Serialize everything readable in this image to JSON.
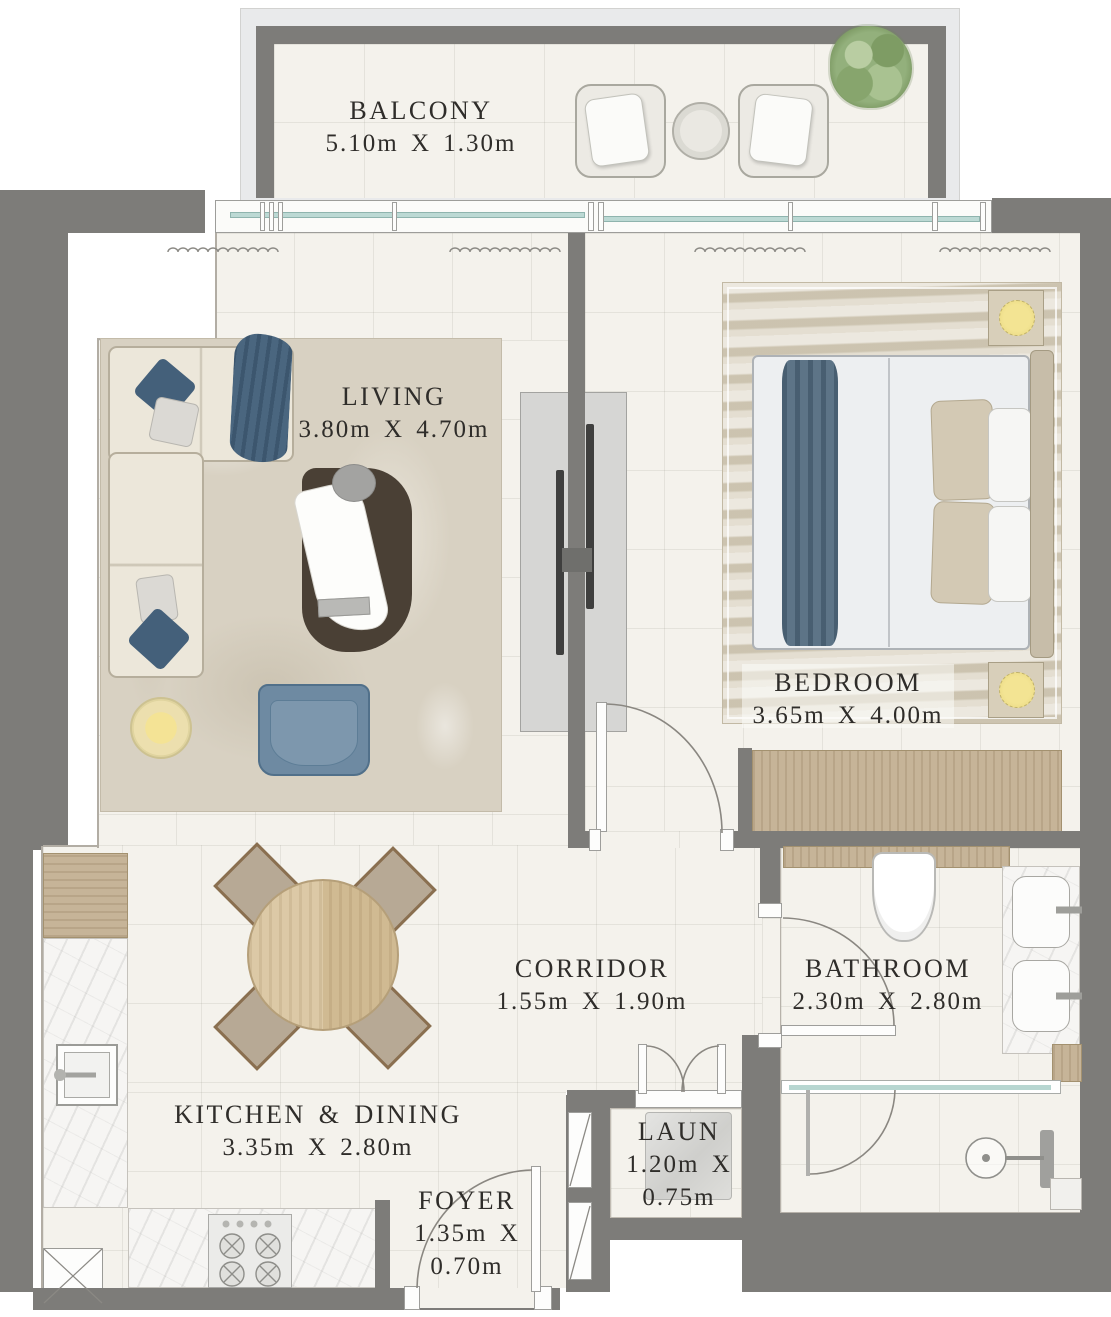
{
  "plan": {
    "type": "apartment-floor-plan",
    "rooms": [
      {
        "id": "balcony",
        "name": "BALCONY",
        "dims": "5.10m X 1.30m",
        "furniture": [
          "potted-plant",
          "lounge-chair",
          "lounge-chair",
          "round-side-table"
        ]
      },
      {
        "id": "living",
        "name": "LIVING",
        "dims": "3.80m X 4.70m",
        "furniture": [
          "corner-sofa",
          "chaise-lounge",
          "armchair",
          "floor-lamp",
          "area-rug",
          "tv-unit"
        ]
      },
      {
        "id": "bedroom",
        "name": "BEDROOM",
        "dims": "3.65m X 4.00m",
        "furniture": [
          "double-bed",
          "nightstand-lamp",
          "nightstand-lamp",
          "wardrobe",
          "area-rug"
        ]
      },
      {
        "id": "corridor",
        "name": "CORRIDOR",
        "dims": "1.55m X 1.90m",
        "furniture": []
      },
      {
        "id": "bathroom",
        "name": "BATHROOM",
        "dims": "2.30m X 2.80m",
        "furniture": [
          "toilet",
          "double-vanity",
          "shower"
        ]
      },
      {
        "id": "kitchen_dining",
        "name": "KITCHEN & DINING",
        "dims": "3.35m X 2.80m",
        "furniture": [
          "kitchen-sink",
          "gas-hob",
          "fridge",
          "counter",
          "round-dining-table",
          "dining-chair",
          "dining-chair",
          "dining-chair",
          "dining-chair"
        ]
      },
      {
        "id": "laundry",
        "name": "LAUN",
        "dims_line1": "1.20m X",
        "dims_line2": "0.75m",
        "furniture": [
          "washing-machine"
        ]
      },
      {
        "id": "foyer",
        "name": "FOYER",
        "dims_line1": "1.35m X",
        "dims_line2": "0.70m",
        "furniture": []
      }
    ],
    "colors": {
      "outside_gray": "#7d7c79",
      "floor": "#f4f2ec",
      "glass_teal": "#bcd9d4",
      "wood": "#c6b498",
      "rug_beige": "#d8d1c2",
      "accent_blue": "#5d7488",
      "lamp_yellow": "#f0dd8e",
      "plant_green": "#8fae79",
      "label_text": "#2f2d2a"
    }
  }
}
